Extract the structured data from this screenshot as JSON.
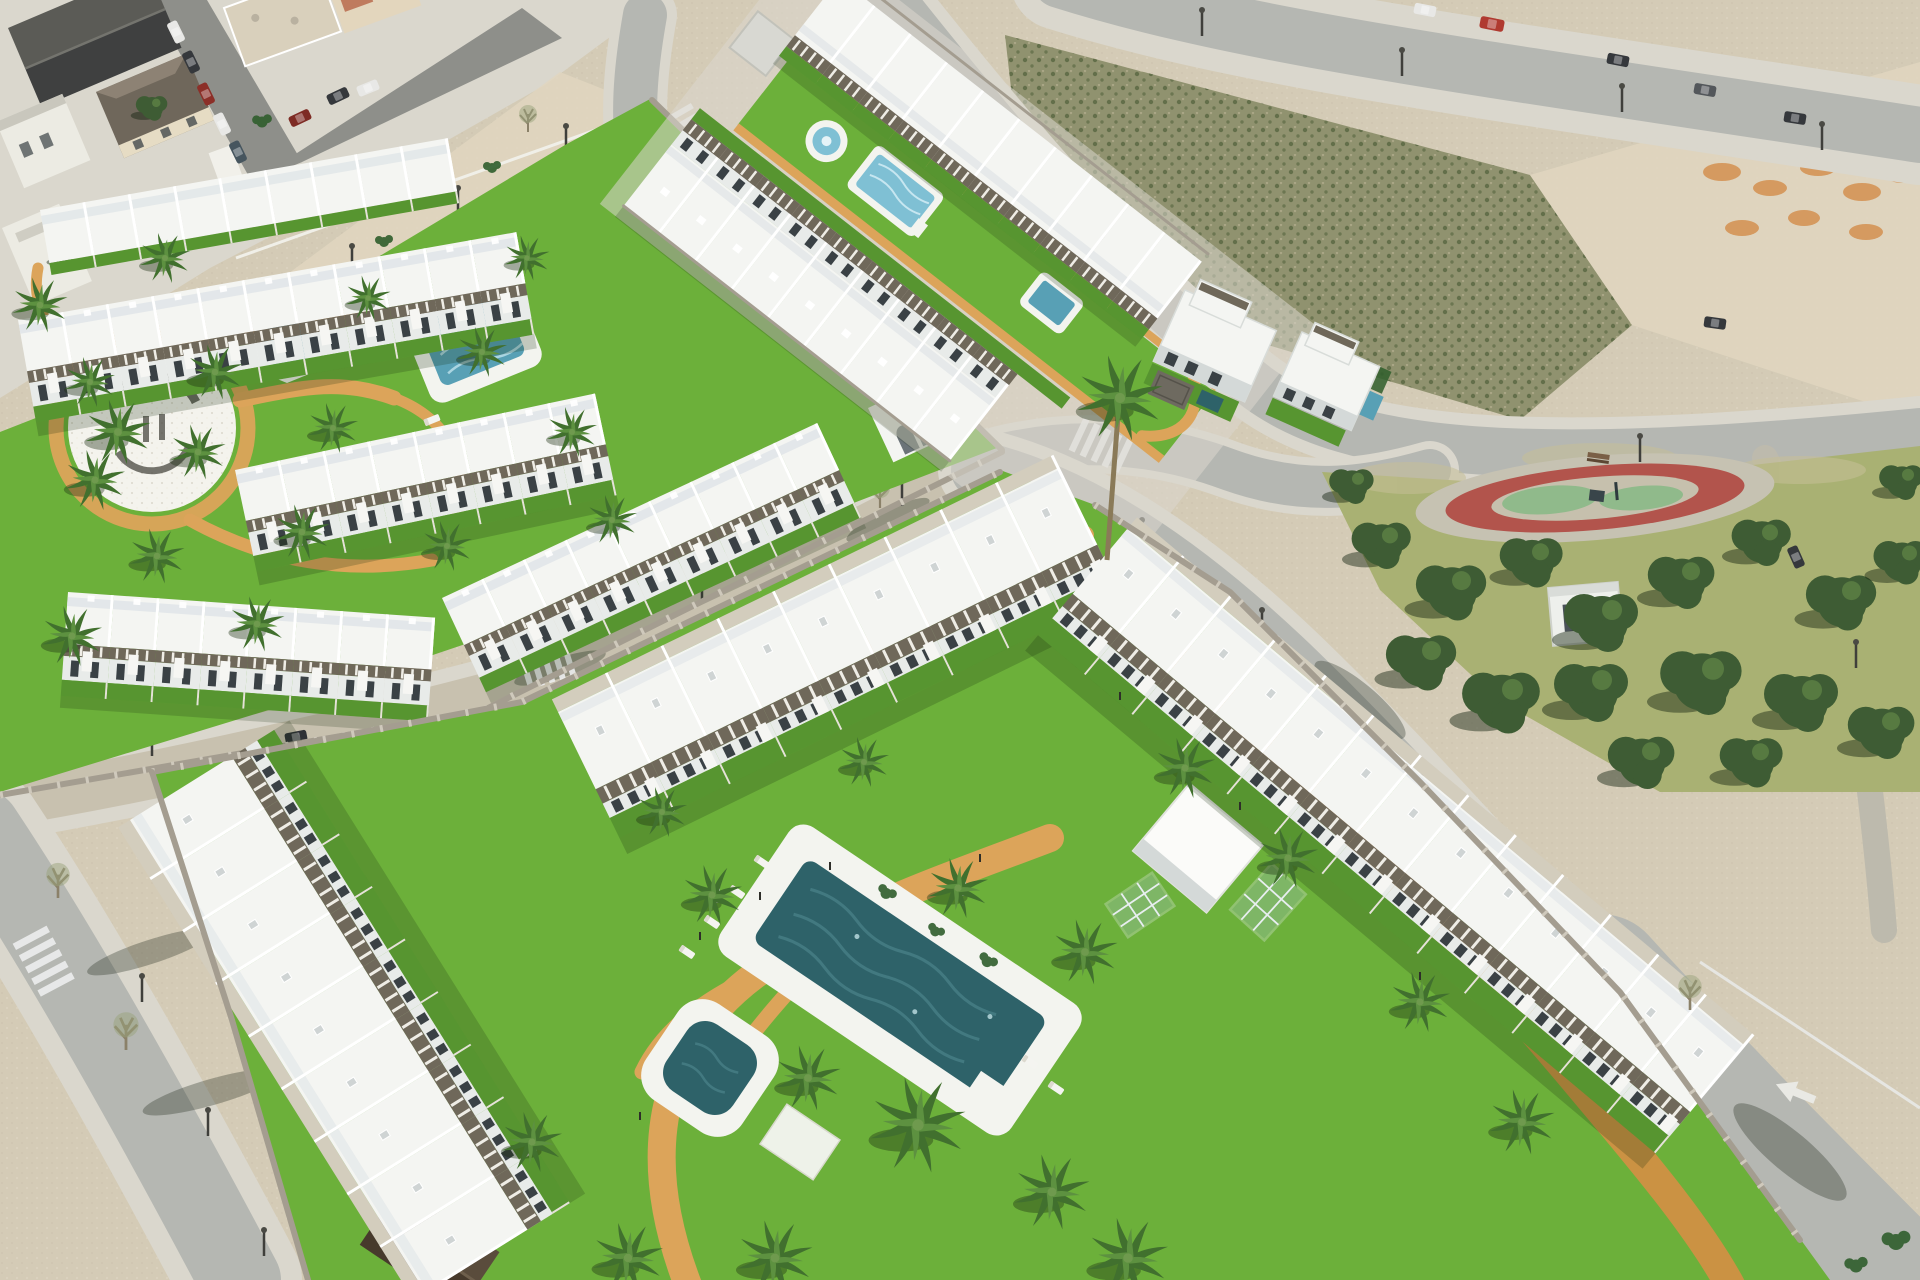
{
  "meta": {
    "title": "Aerial 3D visualisation of new-build residential estates beside an existing Spanish coastal town",
    "type": "architectural-render-photomontage",
    "view": "high-angle aerial, daytime sun from the north-east",
    "readable_text_present": false
  },
  "colors": {
    "sand": "#d4cbb6",
    "sand_light": "#e0d6c0",
    "town_road": "#8e8f8a",
    "town_roof_dark": "#3f4040",
    "town_roof_dark2": "#5b5b56",
    "town_roof_tan": "#d9d0bc",
    "town_roof_brown": "#6f675b",
    "town_wall": "#ecebe3",
    "scrub": "#90926f",
    "scrub_dark": "#5e6b46",
    "dirt": "#d59a60",
    "dirt_dark": "#b07742",
    "road": "#b5b7b2",
    "road_dusty": "#c8c1af",
    "sidewalk": "#dad7cd",
    "wall_stone": "#a49d90",
    "wall_light": "#cfc9bc",
    "lawn": "#6cb03a",
    "lawn_dark": "#579530",
    "park_meadow": "#a9b173",
    "park_dry": "#c6bf97",
    "park_tree": "#3e5c34",
    "park_tree_light": "#5e8245",
    "track_red": "#b2544c",
    "track_inner": "#c6c0ad",
    "play_green": "#90ba8b",
    "path_tan": "#dca45a",
    "path_brick": "#cb9243",
    "roof_white": "#f4f5f2",
    "roof_tint": "#dfe4e7",
    "facade": "#e8ebe9",
    "building_shade": "#d4d9d8",
    "window": "#3a4145",
    "pergola": "#6f685a",
    "deck": "#f3f4ef",
    "pool_light": "#7fc0d4",
    "pool_mid": "#58a0b5",
    "pool_deep": "#2e6269",
    "glass": "#aac4cd",
    "hedge": "#2f5e2c",
    "trunk": "#8a7a58",
    "palm": "#41702e",
    "palm_light": "#5d9140",
    "car_red": "#b03a30",
    "car_dark": "#35383c",
    "car_white": "#e8e8e6",
    "logo_ink": "#54534b"
  },
  "scene": {
    "town": {
      "label": "existing town blocks",
      "features": [
        "dark pitched roofs",
        "flat beige roofs",
        "street lined with parked cars",
        "sandy esplanade with lamp posts"
      ]
    },
    "upper_estate": {
      "label": "terraced townhouse estate with communal garden",
      "townhouse_rows": 5,
      "amenities": [
        "rectangular communal pool with sun deck",
        "octagonal spa island",
        "circular paved plaza with dark ground emblem (illegible)",
        "winding sand-coloured paths",
        "palm garden",
        "perimeter stone wall"
      ]
    },
    "central_estate": {
      "label": "linear estate flanking a long lawn corridor",
      "townhouse_rows": 2,
      "amenities": [
        "round fountain pool",
        "rectangular lap pool",
        "small plunge pool",
        "ochre perimeter path",
        "utility shed",
        "arched stair pavilion"
      ]
    },
    "villas": {
      "label": "detached two-storey villas at the estate entrance",
      "count": 2,
      "features": [
        "roof pergolas",
        "private plunge pools",
        "sunken stone patio",
        "private lawns"
      ]
    },
    "scrub_lot": {
      "label": "vacant overgrown building plot"
    },
    "dirt_mounds": {
      "label": "excavated earth mounds on cleared ground"
    },
    "park": {
      "label": "mature pine park",
      "features": [
        "oval playground with red safety surface and green play islands",
        "play structure",
        "bench",
        "footpath",
        "white utility cabin",
        "street lamps"
      ]
    },
    "lower_estate": {
      "label": "apartment estate around a landscaped courtyard",
      "apartment_rows": 3,
      "amenities": [
        "large rectangular swimming pool with white sun deck",
        "rounded-square spa pool",
        "sun loungers",
        "white pavilion cube",
        "white garden canopy",
        "leaning glass trellis panels",
        "curving brick-paved paths",
        "palm trees on white plinths",
        "perimeter stone wall",
        "dark timber garden gable"
      ]
    },
    "roads": {
      "label": "surrounding street network",
      "features": [
        "zebra crosswalks",
        "street lamps",
        "white lane arrow",
        "sidewalks",
        "roadside trees with long shadows"
      ],
      "crosswalk_count": 5
    },
    "vehicles": {
      "red_cars": 2,
      "white_vehicles": 3,
      "dark_vehicles": 8
    }
  }
}
